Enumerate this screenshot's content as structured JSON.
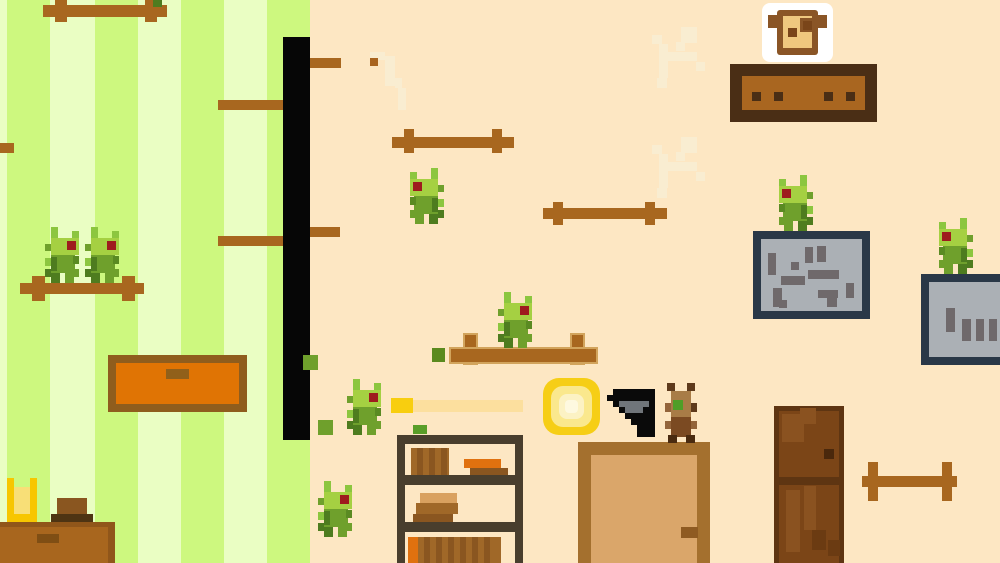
{
  "meta": {
    "scene_name": "pixel-room-platformer",
    "viewport": {
      "width": 1000,
      "height": 563
    }
  },
  "background": {
    "wall_color": "#FDE7C3",
    "striped_wall": {
      "x": 0,
      "y": 0,
      "width": 307,
      "height": 563,
      "pale_color": "#EAFEC3",
      "bright_color": "#CDF87F",
      "bright_stripe_xs": [
        7,
        95,
        181,
        267
      ],
      "stripe_width": 43
    }
  },
  "cracks": {
    "color": "#F9EDD1",
    "instances": [
      {
        "name": "wall-crack",
        "x": 650,
        "y": 26,
        "pattern": "branch"
      },
      {
        "name": "wall-crack",
        "x": 650,
        "y": 136,
        "pattern": "branch"
      },
      {
        "name": "wall-crack",
        "x": 370,
        "y": 48,
        "pattern": "steps"
      }
    ]
  },
  "pole": {
    "x": 283,
    "y": 37,
    "w": 27,
    "h": 403,
    "color": "#060606"
  },
  "wood_color": "#A8671F",
  "wood_platforms": [
    {
      "name": "rail-platform",
      "bar": [
        43,
        5,
        124,
        12
      ],
      "caps": [
        [
          55,
          0,
          12,
          22
        ],
        [
          145,
          0,
          12,
          22
        ]
      ]
    },
    {
      "name": "wall-stub-platform",
      "bar": [
        0,
        143,
        14,
        10
      ],
      "caps": []
    },
    {
      "name": "pole-left-platform",
      "bar": [
        218,
        100,
        65,
        10
      ],
      "caps": []
    },
    {
      "name": "pole-right-platform",
      "bar": [
        310,
        58,
        31,
        10
      ],
      "caps": []
    },
    {
      "name": "pole-left-platform",
      "bar": [
        218,
        236,
        65,
        10
      ],
      "caps": []
    },
    {
      "name": "pole-right-platform",
      "bar": [
        310,
        227,
        30,
        10
      ],
      "caps": []
    },
    {
      "name": "rail-platform",
      "bar": [
        20,
        283,
        124,
        11
      ],
      "caps": [
        [
          32,
          276,
          13,
          25
        ],
        [
          122,
          276,
          13,
          25
        ]
      ]
    },
    {
      "name": "rail-platform",
      "bar": [
        392,
        137,
        122,
        11
      ],
      "caps": [
        [
          404,
          129,
          10,
          24
        ],
        [
          492,
          129,
          10,
          24
        ]
      ]
    },
    {
      "name": "rail-platform",
      "bar": [
        543,
        208,
        124,
        11
      ],
      "caps": [
        [
          553,
          202,
          10,
          23
        ],
        [
          645,
          202,
          10,
          23
        ]
      ]
    },
    {
      "name": "rail-platform",
      "bar": [
        449,
        347,
        145,
        13
      ],
      "caps": [
        [
          463,
          333,
          11,
          28
        ],
        [
          570,
          333,
          11,
          28
        ]
      ],
      "outline": "#D2A45C"
    },
    {
      "name": "rail-platform",
      "bar": [
        862,
        476,
        95,
        11
      ],
      "caps": [
        [
          868,
          462,
          10,
          39
        ],
        [
          942,
          462,
          10,
          39
        ]
      ]
    }
  ],
  "stone_platforms": [
    {
      "name": "stone-platform",
      "x": 753,
      "y": 231,
      "w": 117,
      "h": 88,
      "border": "#2A3847",
      "border_w": 8,
      "fill": "#ABB0B5",
      "mark_color": "#6F696B",
      "marks": [
        [
          768,
          253,
          8,
          22
        ],
        [
          791,
          262,
          8,
          8
        ],
        [
          805,
          247,
          8,
          16
        ],
        [
          817,
          246,
          9,
          16
        ],
        [
          808,
          270,
          31,
          9
        ],
        [
          781,
          276,
          24,
          9
        ],
        [
          773,
          288,
          9,
          19
        ],
        [
          818,
          290,
          20,
          8
        ],
        [
          827,
          296,
          10,
          11
        ],
        [
          846,
          283,
          8,
          15
        ],
        [
          779,
          300,
          8,
          8
        ]
      ]
    },
    {
      "name": "stone-platform",
      "x": 921,
      "y": 274,
      "w": 89,
      "h": 91,
      "border": "#2A3847",
      "border_w": 8,
      "fill": "#ABB0B5",
      "mark_color": "#6F696B",
      "marks": [
        [
          946,
          308,
          9,
          24
        ],
        [
          962,
          319,
          9,
          22
        ],
        [
          976,
          319,
          8,
          22
        ],
        [
          989,
          319,
          8,
          22
        ]
      ]
    }
  ],
  "furniture": {
    "shelf_table": {
      "name": "wall-shelf",
      "x": 730,
      "y": 64,
      "w": 147,
      "h": 58,
      "frame": "#4A2E15",
      "fill": "#A96620",
      "dot_color": "#4A2E15",
      "dot_xs": [
        752,
        774,
        824,
        846
      ],
      "dot_y": 92,
      "dot_size": 9
    },
    "drawer": {
      "name": "orange-drawer",
      "x": 108,
      "y": 355,
      "w": 139,
      "h": 57,
      "frame": "#8F5D1D",
      "fill": "#E07404",
      "handle": [
        166,
        369,
        23,
        10
      ],
      "handle_color": "#91601A"
    },
    "bookshelf": {
      "name": "bookshelf",
      "x": 397,
      "y": 435,
      "w": 126,
      "h": 128,
      "frame": "#493E2D",
      "top": [
        397,
        435,
        126,
        9
      ],
      "shelves": [
        [
          397,
          475,
          126,
          10
        ],
        [
          397,
          522,
          126,
          10
        ]
      ],
      "sides": [
        [
          397,
          435,
          8,
          128
        ],
        [
          515,
          435,
          8,
          128
        ]
      ],
      "books": [
        [
          411,
          448,
          38,
          27,
          "#A06828"
        ],
        [
          417,
          448,
          6,
          27,
          "#8A5620"
        ],
        [
          429,
          448,
          6,
          27,
          "#8A5620"
        ],
        [
          441,
          448,
          6,
          27,
          "#8A5620"
        ],
        [
          464,
          459,
          37,
          9,
          "#E0710F"
        ],
        [
          470,
          468,
          38,
          8,
          "#8A5620"
        ],
        [
          420,
          493,
          37,
          10,
          "#D9A15F"
        ],
        [
          416,
          503,
          42,
          11,
          "#A06828"
        ],
        [
          413,
          514,
          40,
          8,
          "#8A5620"
        ],
        [
          408,
          537,
          10,
          26,
          "#E0710F"
        ],
        [
          418,
          537,
          83,
          26,
          "#A06828"
        ],
        [
          424,
          537,
          6,
          26,
          "#8A5620"
        ],
        [
          436,
          537,
          6,
          26,
          "#8A5620"
        ],
        [
          448,
          537,
          6,
          26,
          "#8A5620"
        ],
        [
          460,
          537,
          6,
          26,
          "#8A5620"
        ],
        [
          472,
          537,
          6,
          26,
          "#8A5620"
        ],
        [
          484,
          537,
          6,
          26,
          "#8A5620"
        ]
      ]
    },
    "side_table": {
      "name": "side-table",
      "x": 0,
      "y": 522,
      "w": 115,
      "h": 41,
      "fill": "#A8661E",
      "shade": "#90561A",
      "handle": [
        37,
        534,
        22,
        9
      ],
      "handle_color": "#7F4E14"
    },
    "box": {
      "name": "wooden-box",
      "base": [
        51,
        514,
        42,
        8
      ],
      "base_color": "#4E3413",
      "body": [
        57,
        498,
        30,
        16
      ],
      "body_color": "#8A5620"
    },
    "gold_cup": {
      "name": "golden-toaster",
      "x": 7,
      "y": 478,
      "w": 30,
      "h": 44,
      "gold": "#F7C600",
      "inner": "#F8DF77"
    },
    "doors": [
      {
        "name": "light-door",
        "x": 578,
        "y": 442,
        "w": 132,
        "h": 121,
        "frame": "#A4702E",
        "frame_w": 13,
        "panel": "#DAA66A",
        "handle": [
          681,
          527,
          17,
          11
        ],
        "handle_color": "#8F5B22"
      },
      {
        "name": "dark-door",
        "x": 774,
        "y": 406,
        "w": 70,
        "h": 157,
        "fill": "#7B4517",
        "edge": "#5E3512",
        "divider_y": 477,
        "patches": [
          [
            782,
            414,
            22,
            28,
            "#8A5220"
          ],
          [
            800,
            408,
            16,
            16,
            "#8A5220"
          ],
          [
            786,
            490,
            14,
            62,
            "#8A5220"
          ],
          [
            804,
            486,
            12,
            44,
            "#8A5220"
          ],
          [
            812,
            530,
            14,
            20,
            "#6B3B12"
          ],
          [
            828,
            540,
            12,
            16,
            "#6B3B12"
          ]
        ],
        "handle": [
          824,
          449,
          10,
          10
        ],
        "handle_color": "#4A280C"
      }
    ]
  },
  "items": {
    "bread": {
      "name": "toast-pickup",
      "x": 762,
      "y": 3,
      "w": 71,
      "h": 59,
      "white": "#FFFFFF",
      "crust": "#8A5526",
      "inner": "#EFC87F",
      "dots": "#7A4519"
    },
    "ring": {
      "name": "energy-ring",
      "x": 543,
      "y": 378,
      "size": 57,
      "layers": [
        "#F6CE16",
        "#FAE88D",
        "#FCF2C4",
        "#FEF9E0"
      ]
    },
    "beam": {
      "name": "beam-projectile",
      "head": [
        391,
        398,
        22,
        15
      ],
      "head_color": "#F8CE0F",
      "trail": [
        413,
        400,
        110,
        12
      ],
      "trail_color": "#FCDF9E"
    },
    "gun": {
      "name": "pistol",
      "x": 607,
      "y": 389,
      "cell": 6,
      "black": "#0A0A0A",
      "gray": "#70757A"
    }
  },
  "creatures": {
    "hopper_colors": {
      "lime": "#8CC63F",
      "head": "#A5D042",
      "mid": "#6FA02C",
      "dark": "#4E7C1F",
      "shade": "#5A8A22",
      "eye": "#9E1B1E"
    },
    "hoppers": [
      {
        "name": "hopper-bug",
        "x": 44,
        "y": 227,
        "facing": "right"
      },
      {
        "name": "hopper-bug",
        "x": 84,
        "y": 227,
        "facing": "right"
      },
      {
        "name": "hopper-bug",
        "x": 410,
        "y": 168,
        "facing": "left"
      },
      {
        "name": "hopper-bug",
        "x": 497,
        "y": 292,
        "facing": "right"
      },
      {
        "name": "hopper-bug",
        "x": 346,
        "y": 379,
        "facing": "right"
      },
      {
        "name": "hopper-bug",
        "x": 317,
        "y": 481,
        "facing": "right"
      },
      {
        "name": "hopper-bug",
        "x": 779,
        "y": 175,
        "facing": "left"
      },
      {
        "name": "hopper-bug",
        "x": 939,
        "y": 218,
        "facing": "left"
      }
    ],
    "ant": {
      "name": "ant-bug",
      "x": 665,
      "y": 383,
      "dark": "#5E3A1C",
      "head": "#A87C47",
      "body": "#7B4A22",
      "nub": "#93643A",
      "foot": "#4A2B10",
      "green_dot": "#4F9E27"
    }
  },
  "particles": [
    {
      "name": "green-chip",
      "x": 303,
      "y": 355,
      "w": 15,
      "h": 15,
      "color": "#6FA02C"
    },
    {
      "name": "green-chip",
      "x": 318,
      "y": 420,
      "w": 15,
      "h": 15,
      "color": "#6FA02C"
    },
    {
      "name": "green-chip",
      "x": 413,
      "y": 425,
      "w": 14,
      "h": 9,
      "color": "#5A9E28"
    },
    {
      "name": "green-chip",
      "x": 432,
      "y": 348,
      "w": 13,
      "h": 14,
      "color": "#5A8A1E"
    },
    {
      "name": "green-chip",
      "x": 153,
      "y": 0,
      "w": 9,
      "h": 7,
      "color": "#4E7C1F"
    },
    {
      "name": "wood-chip",
      "x": 370,
      "y": 58,
      "w": 8,
      "h": 8,
      "color": "#A8641F"
    }
  ]
}
